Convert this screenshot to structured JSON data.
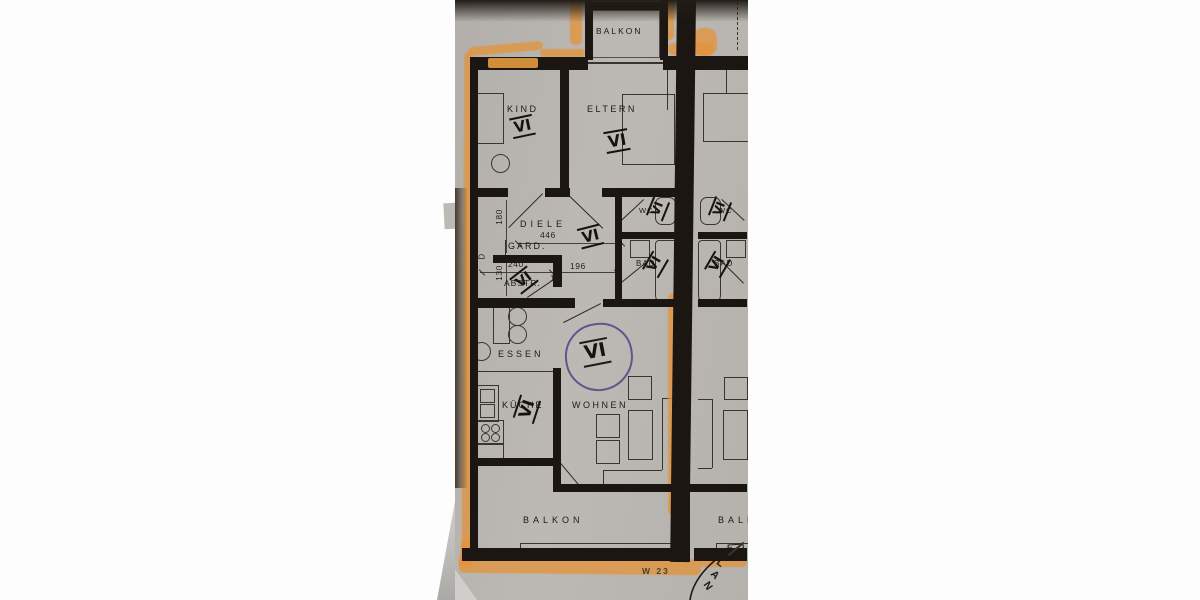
{
  "plan": {
    "rooms": {
      "balkon_top": "BALKON",
      "kind": "KIND",
      "eltern": "ELTERN",
      "diele": "DIELE",
      "gard": "GARD.",
      "abstr": "ABSTR.",
      "wc_left": "WC",
      "bad_left": "BAD",
      "wc_right": "WC",
      "bad_right": "BAD",
      "essen": "ESSEN",
      "kueche": "KÜCHE",
      "wohnen": "WOHNEN",
      "balkon_bottom": "BALKON",
      "balkon_right": "BALKON"
    },
    "dimensions": {
      "hall_length": "446",
      "v180": "180",
      "v130": "130",
      "h240": "240",
      "h196": "196",
      "small10": "10",
      "door_letter": "D"
    },
    "annotations": {
      "unit_mark": "VI",
      "sheet_code": "W 23",
      "arc_letters": [
        "L",
        "A",
        "N"
      ]
    },
    "colors": {
      "paper": "#b8b5b0",
      "ink": "#1b1611",
      "highlighter": "#e4963e",
      "pen_blue": "#5a5a8c"
    }
  }
}
